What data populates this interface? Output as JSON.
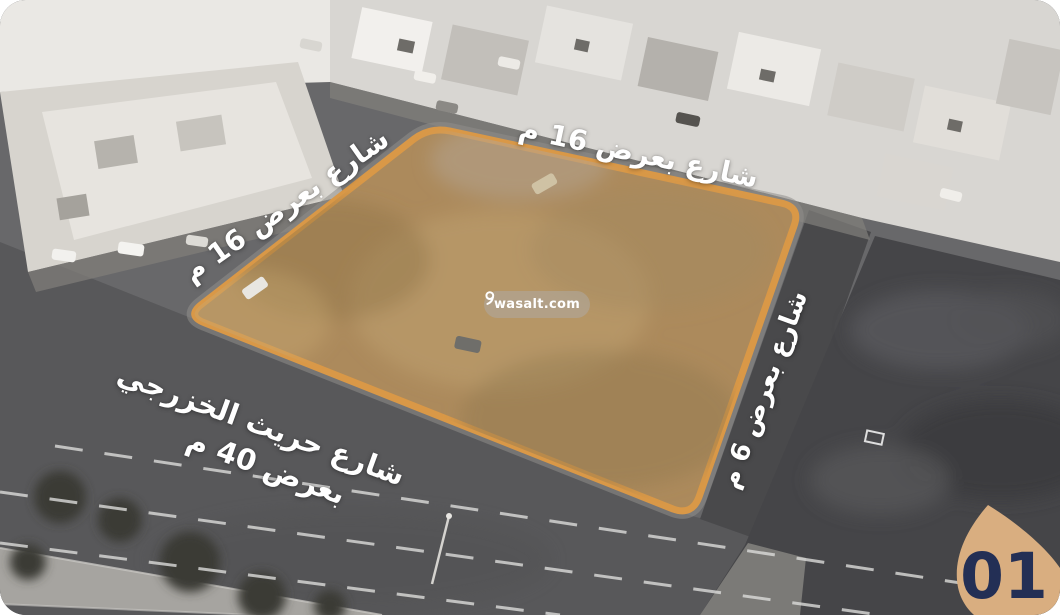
{
  "photo": {
    "street_labels": {
      "top": {
        "text": "شارع بعرض 16 م"
      },
      "left": {
        "text": "شارع بعرض 16 م"
      },
      "right": {
        "text": "شارع بعرض 6 م"
      },
      "bottom": {
        "line1": "شارع حريث الخزرجي",
        "line2": "بعرض 40 م"
      }
    },
    "watermark": {
      "text": "wasalt.com"
    },
    "badge": {
      "number": "01"
    },
    "colors": {
      "plot_fill": "#ac8a5c",
      "plot_border": "#d99847",
      "badge_fill": "#d9ae80",
      "badge_text": "#232f55",
      "label_text": "#ffffff"
    }
  }
}
